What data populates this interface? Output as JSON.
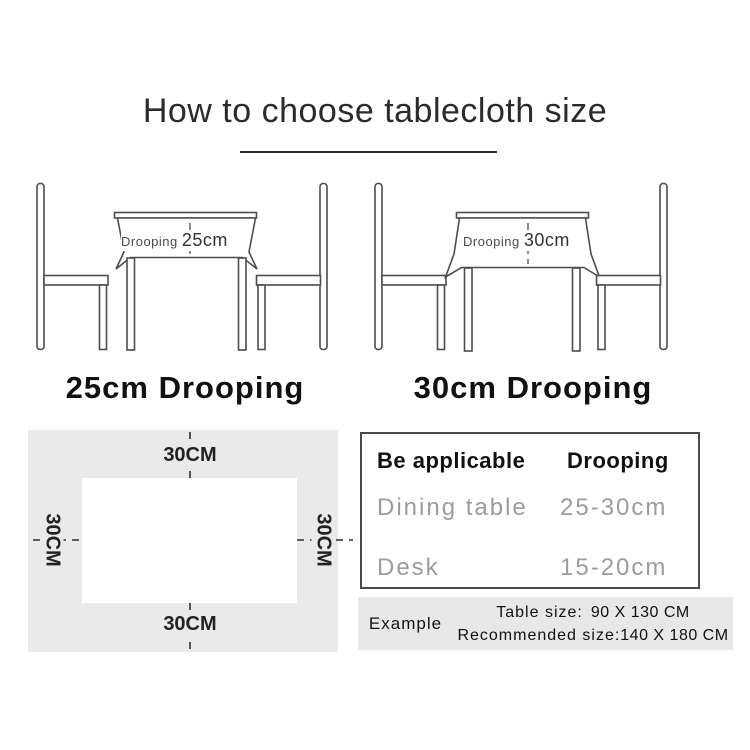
{
  "title": "How to choose tablecloth size",
  "scenes": {
    "left": {
      "drooping_label": "Drooping",
      "drooping_value": "25cm",
      "caption": "25cm Drooping"
    },
    "right": {
      "drooping_label": "Drooping",
      "drooping_value": "30cm",
      "caption": "30cm Drooping"
    }
  },
  "margin_diagram": {
    "top": "30CM",
    "bottom": "30CM",
    "left": "30CM",
    "right": "30CM"
  },
  "spec_table": {
    "col1_header": "Be applicable",
    "col2_header": "Drooping",
    "rows": [
      {
        "name": "Dining table",
        "value": "25-30cm"
      },
      {
        "name": "Desk",
        "value": "15-20cm"
      }
    ]
  },
  "example": {
    "label": "Example",
    "table_size_label": "Table size:",
    "table_size_value": "90 X 130 CM",
    "recommended_label": "Recommended size:",
    "recommended_value": "140 X 180 CM"
  },
  "colors": {
    "line": "#4d4d4d",
    "panel_gray": "#eaeaea",
    "example_gray": "#e8e8e8",
    "muted_text": "#9c9c9c",
    "text": "#1a1a1a"
  }
}
